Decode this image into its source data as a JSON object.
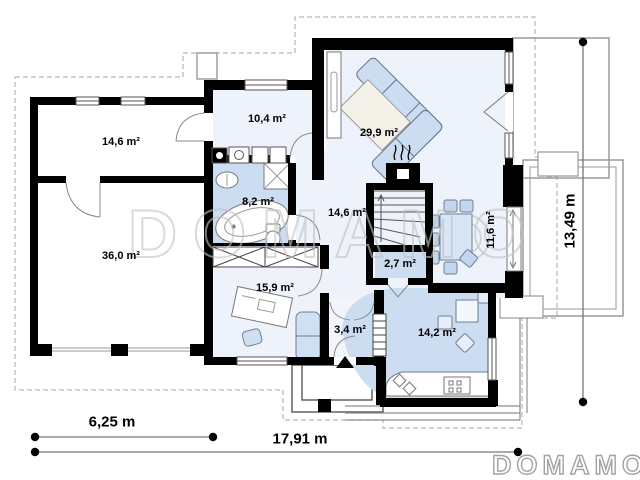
{
  "watermark_text": "DOMAMO",
  "brand_logo": "DOMAMO",
  "room_labels": [
    {
      "id": "storage",
      "area": "14,6 m²"
    },
    {
      "id": "garage",
      "area": "36,0 m²"
    },
    {
      "id": "utility",
      "area": "10,4 m²"
    },
    {
      "id": "bathroom",
      "area": "8,2 m²"
    },
    {
      "id": "hall",
      "area": "14,6 m²"
    },
    {
      "id": "office",
      "area": "15,9 m²"
    },
    {
      "id": "living-room",
      "area": "29,9 m²"
    },
    {
      "id": "dining",
      "area": "11,6 m²"
    },
    {
      "id": "pantry",
      "area": "2,7 m²"
    },
    {
      "id": "entry",
      "area": "3,4 m²"
    },
    {
      "id": "kitchen",
      "area": "14,2 m²"
    }
  ],
  "dimensions": {
    "garage_width": "6,25 m",
    "total_width": "17,91 m",
    "total_depth": "13,49 m"
  }
}
